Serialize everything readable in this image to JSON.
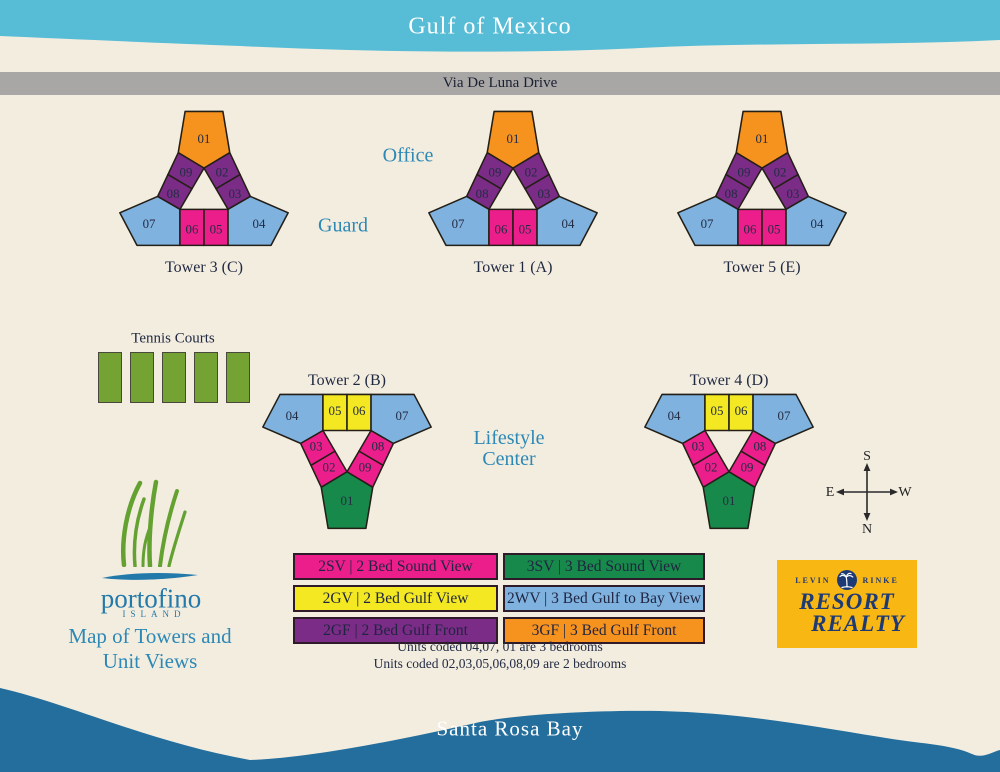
{
  "water": {
    "gulf_label": "Gulf of Mexico",
    "bay_label": "Santa Rosa Bay"
  },
  "road": {
    "label": "Via De Luna Drive"
  },
  "landmarks": {
    "office": "Office",
    "guard": "Guard",
    "lifestyle_line1": "Lifestyle",
    "lifestyle_line2": "Center",
    "tennis_label": "Tennis Courts",
    "tennis_court_count": 5
  },
  "compass": {
    "top": "S",
    "bottom": "N",
    "left": "E",
    "right": "W"
  },
  "towers": [
    {
      "name": "Tower 3 (C)",
      "orientation": "up",
      "label_position": "below",
      "units": [
        {
          "pos": "top",
          "label": "01",
          "view": "3GF"
        },
        {
          "pos": "ul1",
          "label": "09",
          "view": "2GF"
        },
        {
          "pos": "ul2",
          "label": "08",
          "view": "2GF"
        },
        {
          "pos": "ur1",
          "label": "02",
          "view": "2GF"
        },
        {
          "pos": "ur2",
          "label": "03",
          "view": "2GF"
        },
        {
          "pos": "wingL",
          "label": "07",
          "view": "2WV"
        },
        {
          "pos": "ctrL",
          "label": "06",
          "view": "2SV"
        },
        {
          "pos": "ctrR",
          "label": "05",
          "view": "2SV"
        },
        {
          "pos": "wingR",
          "label": "04",
          "view": "2WV"
        }
      ]
    },
    {
      "name": "Tower 1 (A)",
      "orientation": "up",
      "label_position": "below",
      "units": [
        {
          "pos": "top",
          "label": "01",
          "view": "3GF"
        },
        {
          "pos": "ul1",
          "label": "09",
          "view": "2GF"
        },
        {
          "pos": "ul2",
          "label": "08",
          "view": "2GF"
        },
        {
          "pos": "ur1",
          "label": "02",
          "view": "2GF"
        },
        {
          "pos": "ur2",
          "label": "03",
          "view": "2GF"
        },
        {
          "pos": "wingL",
          "label": "07",
          "view": "2WV"
        },
        {
          "pos": "ctrL",
          "label": "06",
          "view": "2SV"
        },
        {
          "pos": "ctrR",
          "label": "05",
          "view": "2SV"
        },
        {
          "pos": "wingR",
          "label": "04",
          "view": "2WV"
        }
      ]
    },
    {
      "name": "Tower 5 (E)",
      "orientation": "up",
      "label_position": "below",
      "units": [
        {
          "pos": "top",
          "label": "01",
          "view": "3GF"
        },
        {
          "pos": "ul1",
          "label": "09",
          "view": "2GF"
        },
        {
          "pos": "ul2",
          "label": "08",
          "view": "2GF"
        },
        {
          "pos": "ur1",
          "label": "02",
          "view": "2GF"
        },
        {
          "pos": "ur2",
          "label": "03",
          "view": "2GF"
        },
        {
          "pos": "wingL",
          "label": "07",
          "view": "2WV"
        },
        {
          "pos": "ctrL",
          "label": "06",
          "view": "2SV"
        },
        {
          "pos": "ctrR",
          "label": "05",
          "view": "2SV"
        },
        {
          "pos": "wingR",
          "label": "04",
          "view": "2WV"
        }
      ]
    },
    {
      "name": "Tower 2 (B)",
      "orientation": "down",
      "label_position": "above",
      "units": [
        {
          "pos": "top",
          "label": "01",
          "view": "3SV"
        },
        {
          "pos": "ul1",
          "label": "02",
          "view": "2SV"
        },
        {
          "pos": "ul2",
          "label": "03",
          "view": "2SV"
        },
        {
          "pos": "ur1",
          "label": "09",
          "view": "2SV"
        },
        {
          "pos": "ur2",
          "label": "08",
          "view": "2SV"
        },
        {
          "pos": "wingL",
          "label": "04",
          "view": "2WV"
        },
        {
          "pos": "ctrL",
          "label": "05",
          "view": "2GV"
        },
        {
          "pos": "ctrR",
          "label": "06",
          "view": "2GV"
        },
        {
          "pos": "wingR",
          "label": "07",
          "view": "2WV"
        }
      ]
    },
    {
      "name": "Tower 4 (D)",
      "orientation": "down",
      "label_position": "above",
      "units": [
        {
          "pos": "top",
          "label": "01",
          "view": "3SV"
        },
        {
          "pos": "ul1",
          "label": "02",
          "view": "2SV"
        },
        {
          "pos": "ul2",
          "label": "03",
          "view": "2SV"
        },
        {
          "pos": "ur1",
          "label": "09",
          "view": "2SV"
        },
        {
          "pos": "ur2",
          "label": "08",
          "view": "2SV"
        },
        {
          "pos": "wingL",
          "label": "04",
          "view": "2WV"
        },
        {
          "pos": "ctrL",
          "label": "05",
          "view": "2GV"
        },
        {
          "pos": "ctrR",
          "label": "06",
          "view": "2GV"
        },
        {
          "pos": "wingR",
          "label": "07",
          "view": "2WV"
        }
      ]
    }
  ],
  "legend": {
    "entries": [
      {
        "code": "2SV",
        "text": "2SV | 2 Bed Sound View",
        "color": "#EC1E8C"
      },
      {
        "code": "2GV",
        "text": "2GV | 2 Bed Gulf View",
        "color": "#F3E821"
      },
      {
        "code": "2GF",
        "text": "2GF | 2 Bed Gulf Front",
        "color": "#7B2C86"
      },
      {
        "code": "3SV",
        "text": "3SV | 3 Bed Sound View",
        "color": "#17894A"
      },
      {
        "code": "2WV",
        "text": "2WV | 3 Bed Gulf to Bay View",
        "color": "#7FB2DF"
      },
      {
        "code": "3GF",
        "text": "3GF | 3 Bed Gulf Front",
        "color": "#F6921E"
      }
    ]
  },
  "notes": {
    "line1": "Units coded 04,07, 01 are 3 bedrooms",
    "line2": "Units coded 02,03,05,06,08,09 are 2 bedrooms"
  },
  "branding": {
    "portofino_name": "portofino",
    "portofino_sub": "ISLAND",
    "map_title_line1": "Map of Towers and",
    "map_title_line2": "Unit Views",
    "realty_left": "LEVIN",
    "realty_right": "RINKE",
    "realty_line1": "RESORT",
    "realty_line2": "REALTY"
  },
  "colors": {
    "background": "#F3EDE0",
    "gulf_band": "#57BCD5",
    "bay": "#236E9D",
    "road": "#A8A7A5",
    "poi_label_blue": "#2C88B5",
    "dark_text": "#232C44",
    "unit_outline": "#241F16",
    "tennis_green": "#74A233",
    "realty_gold": "#F9B713",
    "realty_navy": "#1E3A75",
    "portofino_blue": "#2379A9",
    "grass_green": "#63A131"
  }
}
